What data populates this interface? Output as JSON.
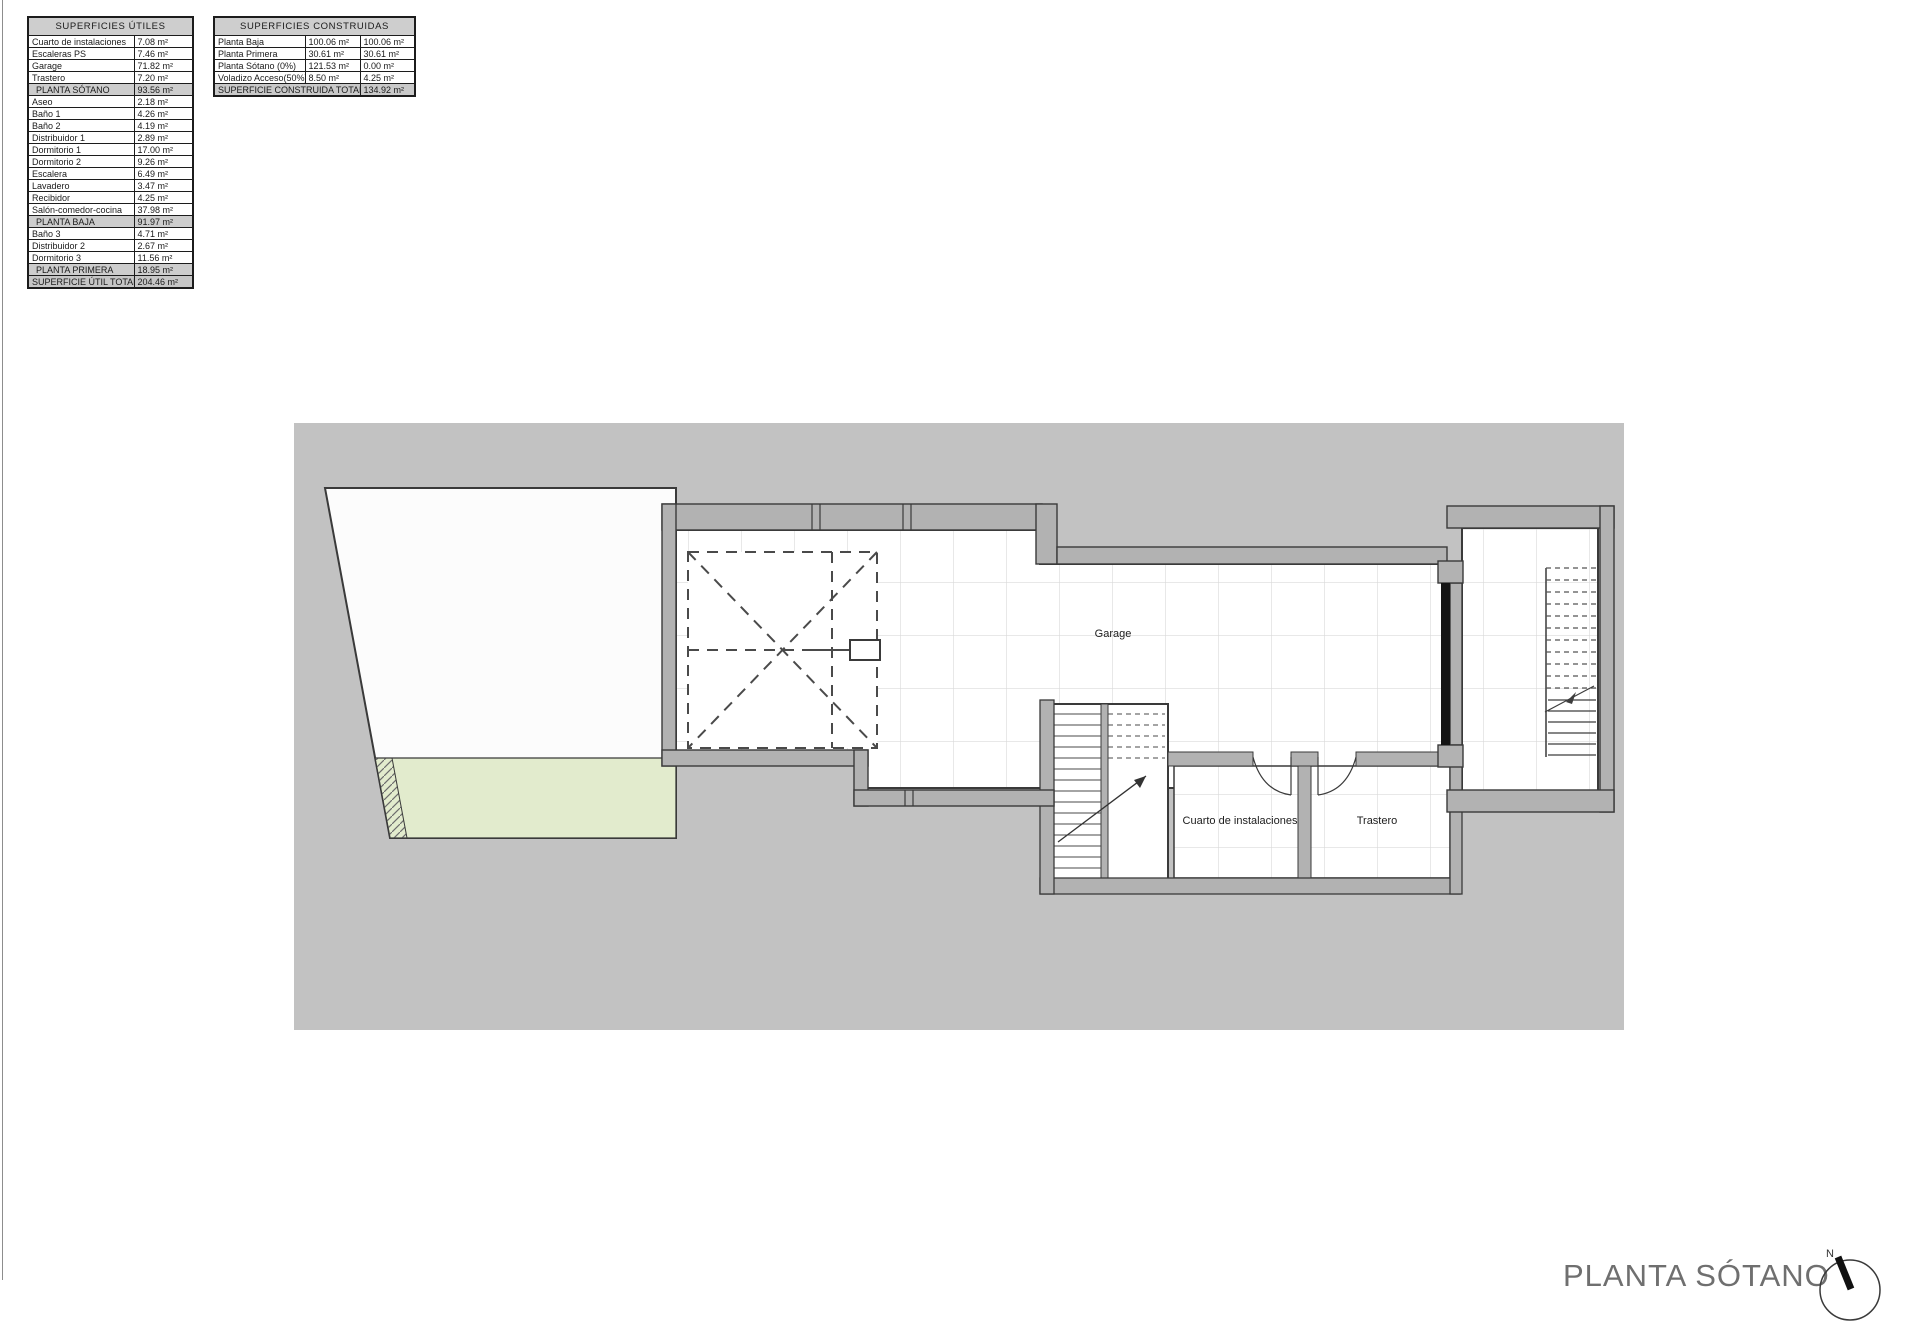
{
  "page": {
    "title_label": "PLANTA SÓTANO",
    "north_label": "N"
  },
  "tables": {
    "utiles": {
      "title": "SUPERFICIES ÚTILES",
      "rows": [
        {
          "label": "Cuarto de instalaciones",
          "value": "7.08 m²"
        },
        {
          "label": "Escaleras PS",
          "value": "7.46 m²"
        },
        {
          "label": "Garage",
          "value": "71.82 m²"
        },
        {
          "label": "Trastero",
          "value": "7.20 m²"
        },
        {
          "label": "PLANTA SÓTANO",
          "value": "93.56 m²",
          "type": "sub"
        },
        {
          "label": "Aseo",
          "value": "2.18 m²"
        },
        {
          "label": "Baño 1",
          "value": "4.26 m²"
        },
        {
          "label": "Baño 2",
          "value": "4.19 m²"
        },
        {
          "label": "Distribuidor 1",
          "value": "2.89 m²"
        },
        {
          "label": "Dormitorio 1",
          "value": "17.00 m²"
        },
        {
          "label": "Dormitorio 2",
          "value": "9.26 m²"
        },
        {
          "label": "Escalera",
          "value": "6.49 m²"
        },
        {
          "label": "Lavadero",
          "value": "3.47 m²"
        },
        {
          "label": "Recibidor",
          "value": "4.25 m²"
        },
        {
          "label": "Salón-comedor-cocina",
          "value": "37.98 m²"
        },
        {
          "label": "PLANTA BAJA",
          "value": "91.97 m²",
          "type": "sub"
        },
        {
          "label": "Baño 3",
          "value": "4.71 m²"
        },
        {
          "label": "Distribuidor 2",
          "value": "2.67 m²"
        },
        {
          "label": "Dormitorio 3",
          "value": "11.56 m²"
        },
        {
          "label": "PLANTA PRIMERA",
          "value": "18.95 m²",
          "type": "sub"
        },
        {
          "label": "SUPERFICIE ÚTIL TOTAL",
          "value": "204.46 m²",
          "type": "total"
        }
      ]
    },
    "construidas": {
      "title": "SUPERFICIES CONSTRUIDAS",
      "rows": [
        {
          "label": "Planta Baja",
          "value1": "100.06 m²",
          "value2": "100.06 m²"
        },
        {
          "label": "Planta Primera",
          "value1": "30.61 m²",
          "value2": "30.61 m²"
        },
        {
          "label": "Planta Sótano (0%)",
          "value1": "121.53 m²",
          "value2": "0.00 m²"
        },
        {
          "label": "Voladizo Acceso(50%)",
          "value1": "8.50 m²",
          "value2": "4.25 m²"
        }
      ],
      "total": {
        "label": "SUPERFICIE CONSTRUIDA TOTAL",
        "value": "134.92 m²"
      }
    }
  },
  "plan": {
    "labels": {
      "garage": "Garage",
      "room_instalaciones": "Cuarto de instalaciones",
      "room_trastero": "Trastero"
    },
    "colors": {
      "canvas": "#c2c2c2",
      "wall": "#b2b2b2",
      "line": "#3a3a3a",
      "tile_line": "#d9d9d9",
      "pool": "#e2ebcd",
      "door_band": "#151515"
    }
  }
}
